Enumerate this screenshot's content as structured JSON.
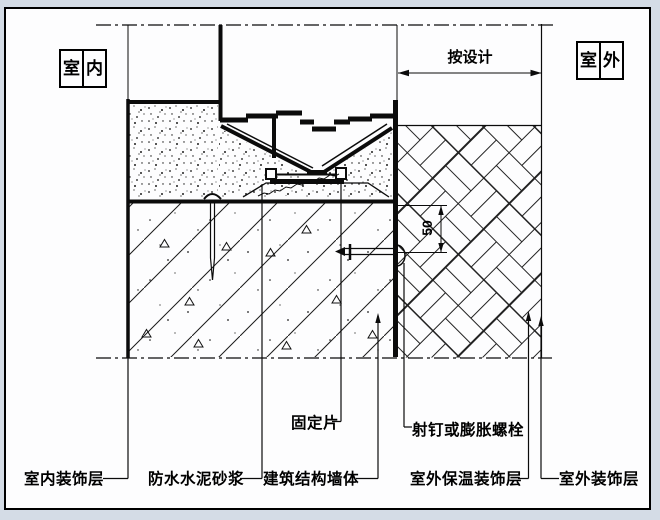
{
  "title_labels": {
    "indoor_box": {
      "chars": [
        "室",
        "内"
      ]
    },
    "outdoor_box": {
      "chars": [
        "室",
        "外"
      ]
    }
  },
  "dimensions": {
    "design_width": "按设计",
    "edge_distance": "50"
  },
  "callouts": {
    "interior_finish": "室内装饰层",
    "waterproof_mortar": "防水水泥砂浆",
    "structural_wall": "建筑结构墙体",
    "fixing_plate": "固定片",
    "nail_or_bolt": "射钉或膨胀螺栓",
    "exterior_insulation_finish": "室外保温装饰层",
    "exterior_finish": "室外装饰层"
  },
  "colors": {
    "ink": "#0b0b0b",
    "paper": "#fdfdfe",
    "background": "#d4dce6"
  }
}
